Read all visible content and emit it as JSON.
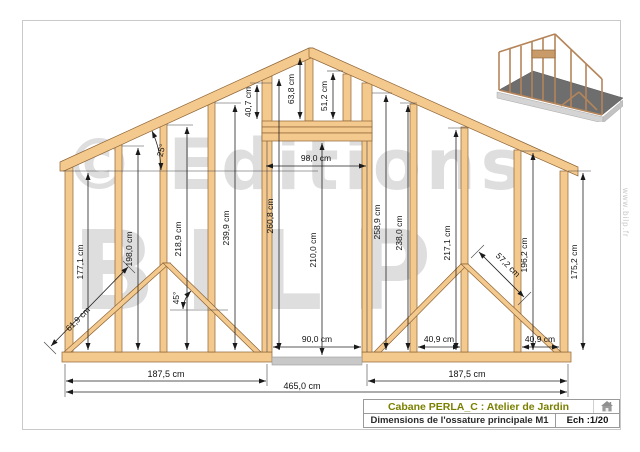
{
  "watermark": {
    "brand_top": "© Editions",
    "brand_bottom": "BILP",
    "website": "www.bilp.fr"
  },
  "title_block": {
    "project_title": "Cabane PERLA_C : Atelier de Jardin",
    "drawing_title": "Dimensions de l'ossature principale M1",
    "scale_label": "Ech :1/20"
  },
  "dimensions": {
    "left_wall": {
      "stud1": "177,1 cm",
      "stud2": "198,0 cm",
      "stud3": "218,9 cm",
      "stud4": "239,9 cm",
      "door_king": "260,8 cm"
    },
    "right_wall": {
      "door_king": "258,9 cm",
      "stud5": "238,0 cm",
      "stud6": "217,1 cm",
      "stud7": "196,2 cm",
      "end_stud": "175,2 cm"
    },
    "gable": {
      "jamb_extension": "40,7 cm",
      "king_stud": "63,8 cm",
      "right_stud": "51,2 cm",
      "header_span": "98,0 cm"
    },
    "door": {
      "width": "90,0 cm",
      "height": "210,0 cm"
    },
    "braces": {
      "left_length": "61,9 cm",
      "right_length": "57,2 cm",
      "brace_angle": "45°",
      "roof_angle": "25°"
    },
    "bottom": {
      "left_span": "187,5 cm",
      "total_span": "465,0 cm",
      "right_span": "187,5 cm"
    },
    "stud_spacing": {
      "first": "40,9 cm",
      "second": "40,9 cm"
    }
  },
  "colors": {
    "wood_fill": "#f4c98e",
    "wood_edge": "#8d6436",
    "dimension_line": "#222222",
    "watermark_gray": "#dedede",
    "title_green": "#7a8000",
    "sill_gray": "#c8c8c8",
    "floor_3d": "#6e6e6e"
  }
}
